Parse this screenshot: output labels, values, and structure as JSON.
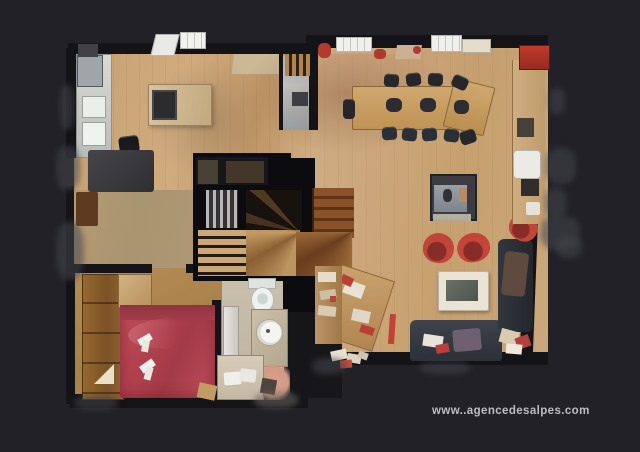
{
  "theme": {
    "bg": "#212127",
    "wall": "#131318",
    "floor-oak": "#c7a272",
    "floor-oak-light": "#d3b186",
    "floor-tile": "#c6bcab",
    "bed-red": "#b2414f",
    "accent-red": "#c2453a",
    "sofa-dark": "#343942",
    "counter-light": "#cbccc8",
    "stair-brown": "#7c4a26",
    "stair-oak": "#b78a55",
    "noise-gray": "#44454c",
    "cream": "#eae4d6",
    "tile-salmon": "#d89d89",
    "watermark": "#cdcdd2"
  },
  "watermark": {
    "text": "www..agencedesalpes.com"
  },
  "scene": {
    "description": "Top-down 3D dollhouse scan floor plan of a chalet level on dark background",
    "rooms": [
      {
        "id": "kitchen"
      },
      {
        "id": "great-room"
      },
      {
        "id": "hallway"
      },
      {
        "id": "staircase"
      },
      {
        "id": "bedroom"
      },
      {
        "id": "bathroom"
      },
      {
        "id": "store-room"
      }
    ],
    "furniture": [
      "kitchen-island",
      "kitchen-counter",
      "fridge",
      "dark-table",
      "dining-table",
      "dining-chairs",
      "fireplace-stove",
      "red-armchair",
      "coffee-table",
      "sofa",
      "chaise-longue",
      "sideboard",
      "red-cabinet",
      "writing-desk",
      "double-bed",
      "wardrobe",
      "dresser",
      "toilet",
      "washbasin",
      "bathtub",
      "shower",
      "towels"
    ]
  }
}
